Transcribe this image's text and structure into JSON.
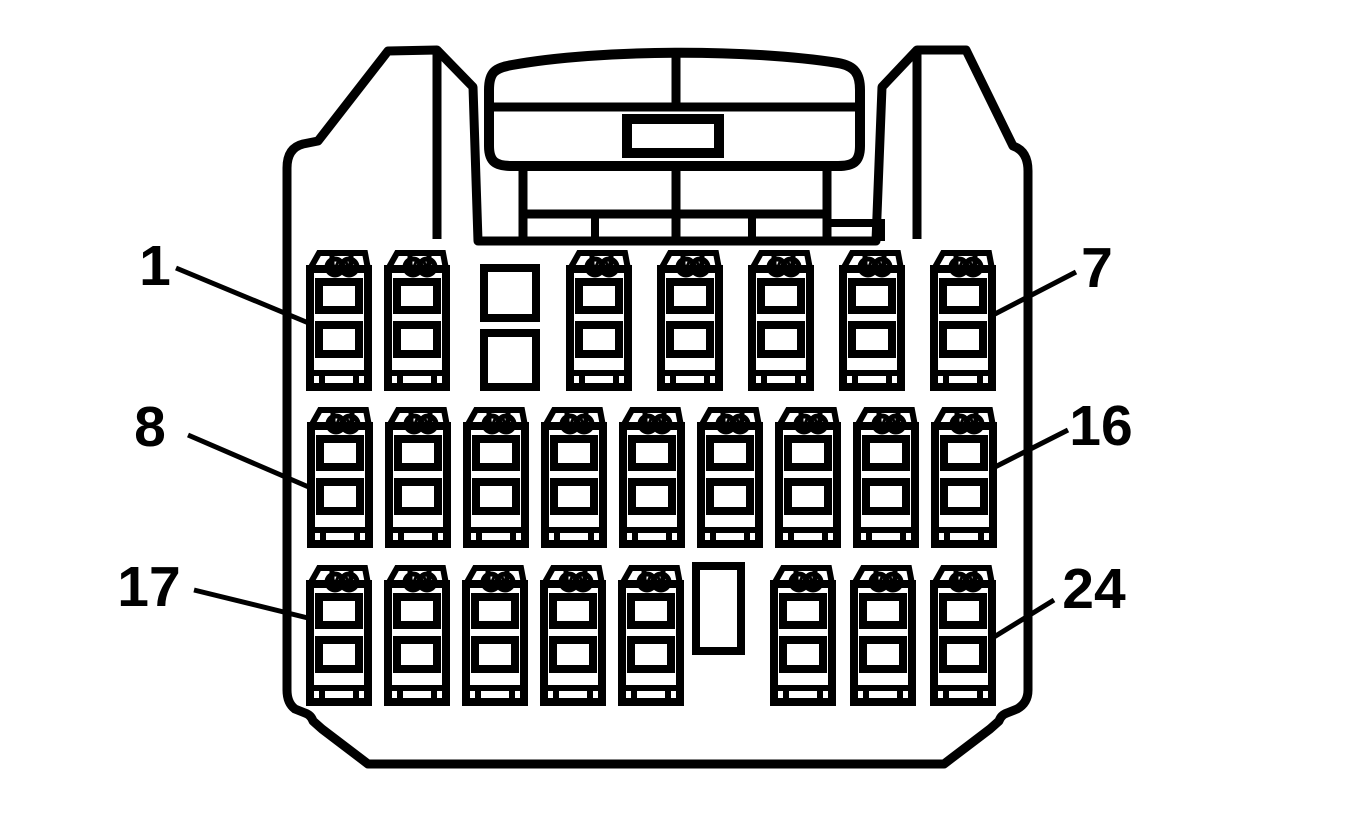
{
  "figure": {
    "kind": "connector-face-pinout-diagram",
    "total_pins": 24
  },
  "colors": {
    "line": "#000000",
    "background": "#ffffff"
  },
  "callouts": [
    {
      "text": "1",
      "side": "left",
      "row": "top"
    },
    {
      "text": "7",
      "side": "right",
      "row": "top"
    },
    {
      "text": "8",
      "side": "left",
      "row": "middle"
    },
    {
      "text": "16",
      "side": "right",
      "row": "middle"
    },
    {
      "text": "17",
      "side": "left",
      "row": "bottom"
    },
    {
      "text": "24",
      "side": "right",
      "row": "bottom"
    }
  ],
  "pin_rows": [
    {
      "row": "top",
      "first_pin": 1,
      "last_pin": 7,
      "terminal_count": 7,
      "keyway": "two stacked square cavities between pin 2 and pin 3"
    },
    {
      "row": "middle",
      "first_pin": 8,
      "last_pin": 16,
      "terminal_count": 9,
      "keyway": null
    },
    {
      "row": "bottom",
      "first_pin": 17,
      "last_pin": 24,
      "terminal_count": 8,
      "keyway": "tall vertical slot between pin 21 and pin 22"
    }
  ]
}
